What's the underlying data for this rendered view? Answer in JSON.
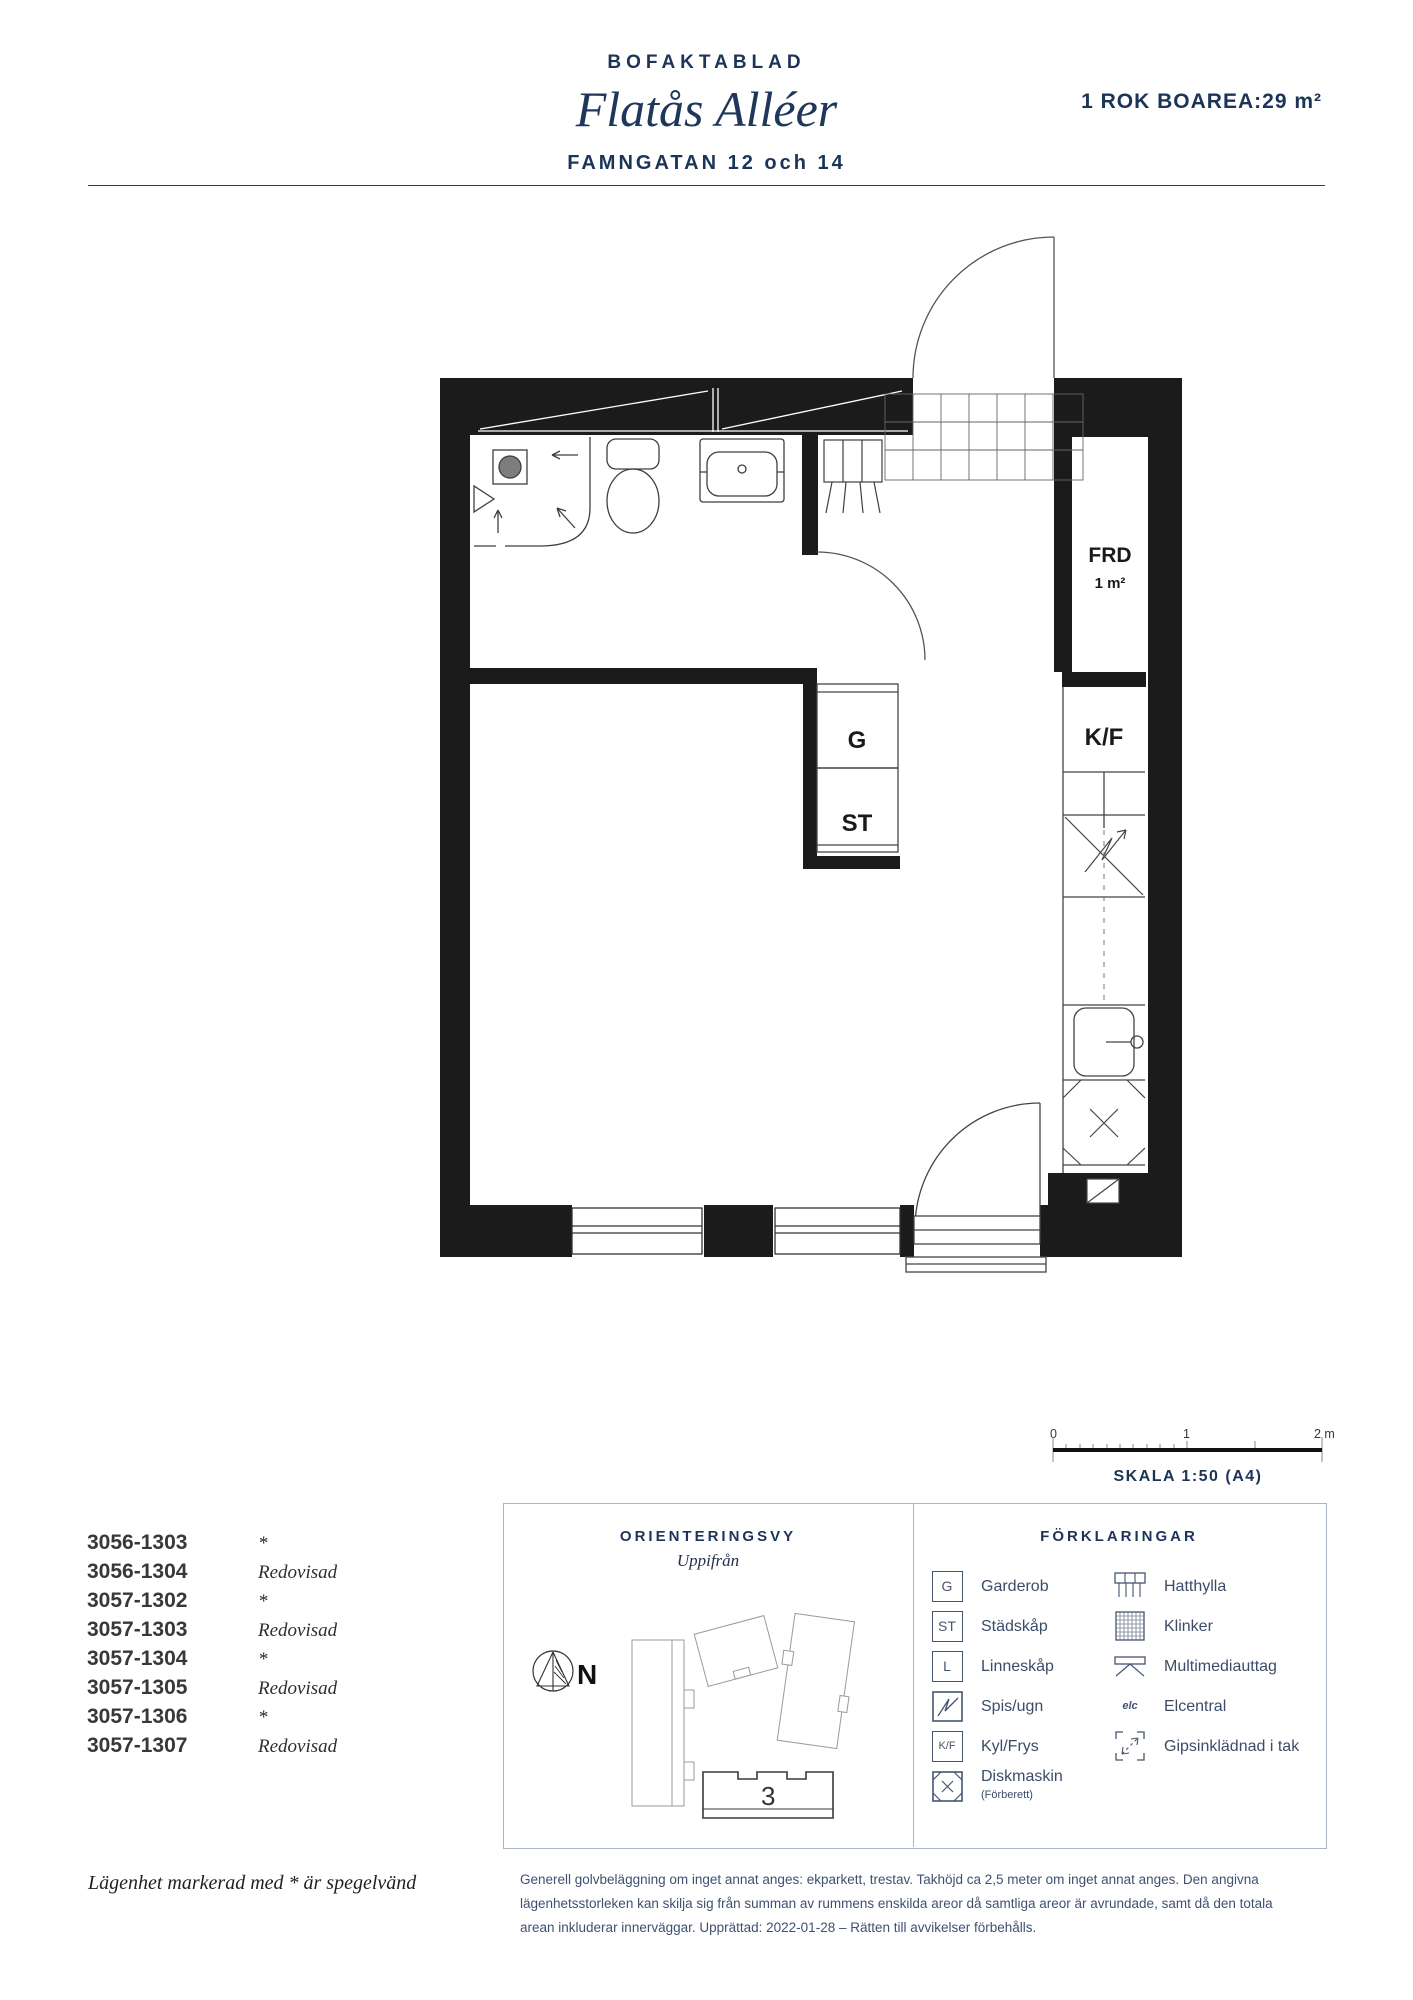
{
  "header": {
    "doc_type": "BOFAKTABLAD",
    "project": "Flatås Alléer",
    "street": "FAMNGATAN 12 och 14",
    "apartment_info": "1 ROK BOAREA:29 m²"
  },
  "plan": {
    "frd_label": "FRD",
    "frd_area": "1 m²",
    "g_label": "G",
    "st_label": "ST",
    "kf_label": "K/F"
  },
  "scale": {
    "tick0": "0",
    "tick1": "1",
    "tick2": "2 meter",
    "label": "SKALA 1:50 (A4)"
  },
  "apartment_list": [
    {
      "number": "3056-1303",
      "status": "*"
    },
    {
      "number": "3056-1304",
      "status": "Redovisad"
    },
    {
      "number": "3057-1302",
      "status": "*"
    },
    {
      "number": "3057-1303",
      "status": "Redovisad"
    },
    {
      "number": "3057-1304",
      "status": "*"
    },
    {
      "number": "3057-1305",
      "status": "Redovisad"
    },
    {
      "number": "3057-1306",
      "status": "*"
    },
    {
      "number": "3057-1307",
      "status": "Redovisad"
    }
  ],
  "orientation": {
    "title": "ORIENTERINGSVY",
    "subtitle": "Uppifrån",
    "north": "N",
    "building_number": "3"
  },
  "legend": {
    "title": "FÖRKLARINGAR",
    "left": [
      {
        "symbol": "G",
        "label": "Garderob"
      },
      {
        "symbol": "ST",
        "label": "Städskåp"
      },
      {
        "symbol": "L",
        "label": "Linneskåp"
      },
      {
        "symbol": "",
        "label": "Spis/ugn"
      },
      {
        "symbol": "K/F",
        "label": "Kyl/Frys"
      },
      {
        "symbol": "",
        "label": "Diskmaskin",
        "note": "(Förberett)"
      }
    ],
    "right": [
      {
        "label": "Hatthylla"
      },
      {
        "label": "Klinker"
      },
      {
        "label": "Multimediauttag"
      },
      {
        "label": "Elcentral",
        "symbol": "elc"
      },
      {
        "label": "Gipsinklädnad i tak"
      }
    ]
  },
  "footer": {
    "mirror_note": "Lägenhet markerad med * är spegelvänd",
    "general_note": "Generell golvbeläggning om inget annat anges: ekparkett, trestav. Takhöjd ca 2,5 meter om inget annat anges. Den angivna lägenhetsstorleken kan skilja sig från summan av rummens enskilda areor då samtliga areor är avrundade, samt då den totala arean inkluderar innerväggar. Upprättad: 2022-01-28 – Rätten till avvikelser förbehålls."
  },
  "colors": {
    "navy": "#1c3457",
    "text_blue": "#3c4c68",
    "wall": "#1b1b1b"
  }
}
